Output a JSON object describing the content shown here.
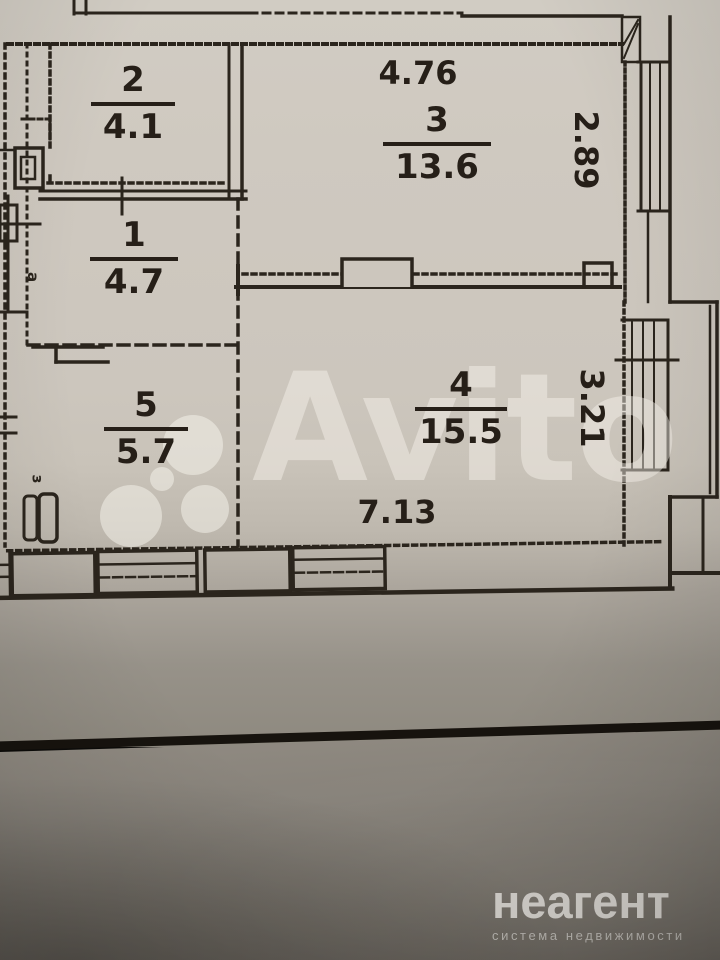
{
  "plan": {
    "rooms": [
      {
        "number": "2",
        "area": "4.1"
      },
      {
        "number": "1",
        "area": "4.7"
      },
      {
        "number": "5",
        "area": "5.7"
      },
      {
        "number": "3",
        "area": "13.6"
      },
      {
        "number": "4",
        "area": "15.5"
      }
    ],
    "dimensions": {
      "top": "4.76",
      "right_upper": "2.89",
      "right_lower": "3.21",
      "bottom": "7.13"
    },
    "shaft_labels": {
      "upper": "а",
      "lower": "з"
    }
  },
  "watermark": {
    "brand": "Avito"
  },
  "branding": {
    "name": "неагент",
    "tagline": "система недвижимости"
  },
  "colors": {
    "paper": "#ccc6bd",
    "ink": "#2b251d",
    "table": "#736e66",
    "logo_text": "#d3d0cb"
  }
}
